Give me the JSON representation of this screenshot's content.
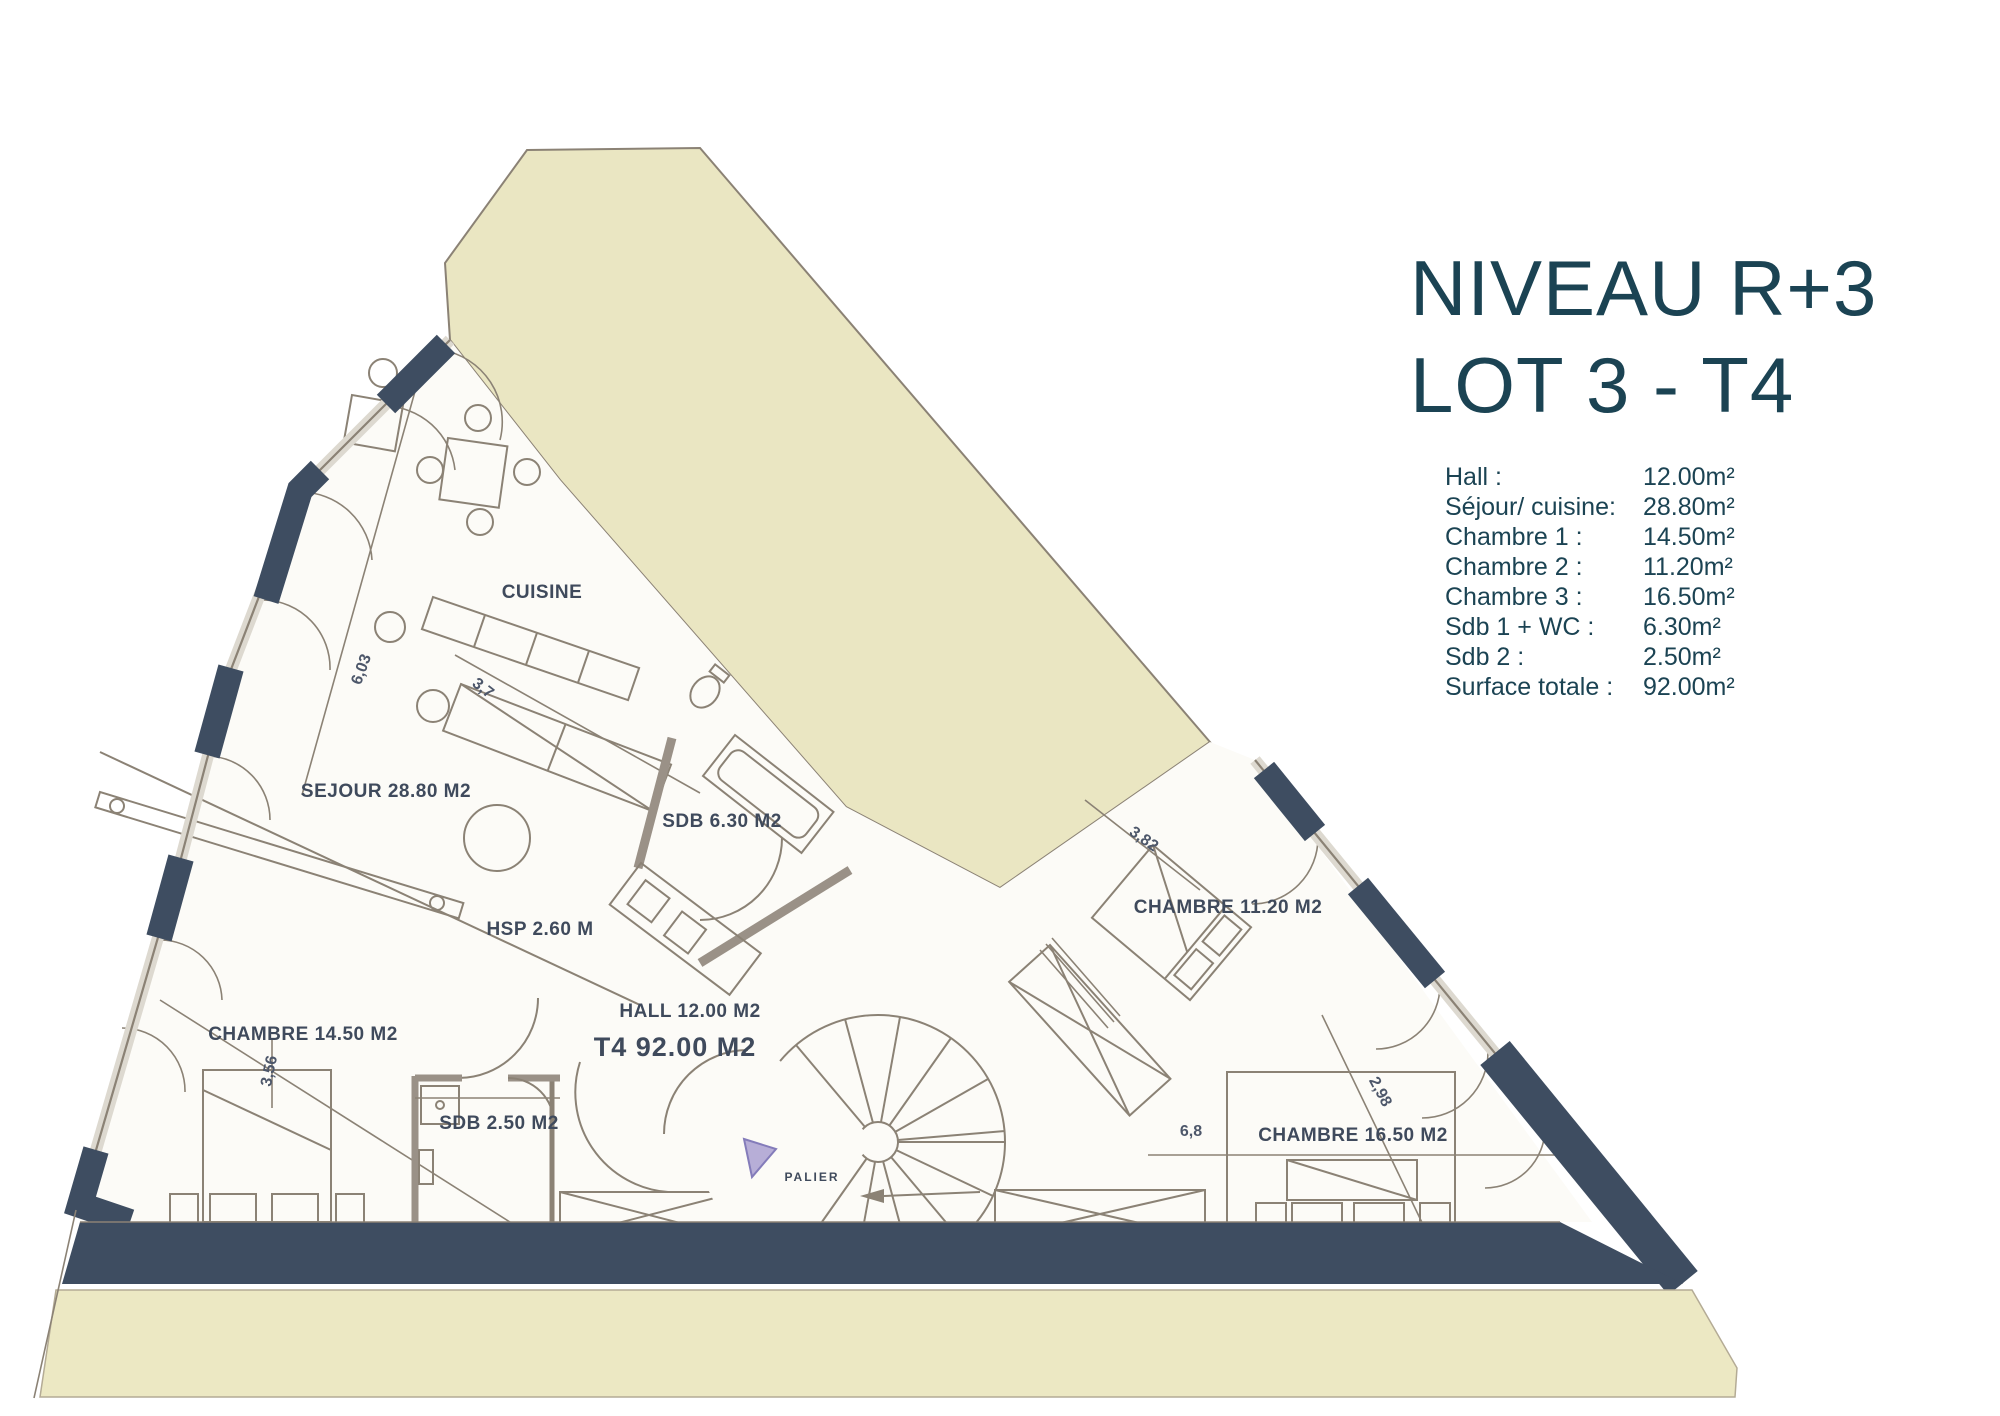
{
  "title": {
    "line1": "NIVEAU R+3",
    "line2": "LOT 3 - T4"
  },
  "legend": {
    "rows": [
      {
        "label": "Hall :",
        "value": "12.00m²"
      },
      {
        "label": "Séjour/ cuisine:",
        "value": "28.80m²"
      },
      {
        "label": "Chambre 1 :",
        "value": "14.50m²"
      },
      {
        "label": "Chambre 2 :",
        "value": "11.20m²"
      },
      {
        "label": "Chambre 3 :",
        "value": "16.50m²"
      },
      {
        "label": "Sdb 1 + WC :",
        "value": "6.30m²"
      },
      {
        "label": "Sdb 2 :",
        "value": "2.50m²"
      },
      {
        "label": "Surface totale :",
        "value": "92.00m²"
      }
    ]
  },
  "plan": {
    "labels": [
      {
        "id": "cuisine",
        "text": "CUISINE"
      },
      {
        "id": "sejour",
        "text": "SEJOUR 28.80 M2"
      },
      {
        "id": "sdb1",
        "text": "SDB 6.30 M2"
      },
      {
        "id": "hsp",
        "text": "HSP 2.60 M"
      },
      {
        "id": "hall",
        "text": "HALL 12.00 M2"
      },
      {
        "id": "lot",
        "text": "T4 92.00 M2"
      },
      {
        "id": "chambre2",
        "text": "CHAMBRE 11.20 M2"
      },
      {
        "id": "chambre1",
        "text": "CHAMBRE 14.50 M2"
      },
      {
        "id": "sdb2",
        "text": "SDB 2.50 M2"
      },
      {
        "id": "chambre3",
        "text": "CHAMBRE 16.50 M2"
      },
      {
        "id": "palier",
        "text": "PALIER"
      }
    ],
    "dims": [
      {
        "id": "sejour-width",
        "text": "6,03"
      },
      {
        "id": "counter-length",
        "text": "3,7"
      },
      {
        "id": "chambre2-width",
        "text": "3,82"
      },
      {
        "id": "chambre1-width",
        "text": "3,56"
      },
      {
        "id": "chambre3-depth",
        "text": "2,98"
      },
      {
        "id": "chambre3-width",
        "text": "6,8"
      }
    ],
    "colors": {
      "terrace_beige": "#eae6c2",
      "band_beige": "#ece8c3",
      "wall_navy": "#3e4d61",
      "line_grey": "#8b8275",
      "title_teal": "#1b4353",
      "triangle_purple": "#b7aed7"
    }
  }
}
